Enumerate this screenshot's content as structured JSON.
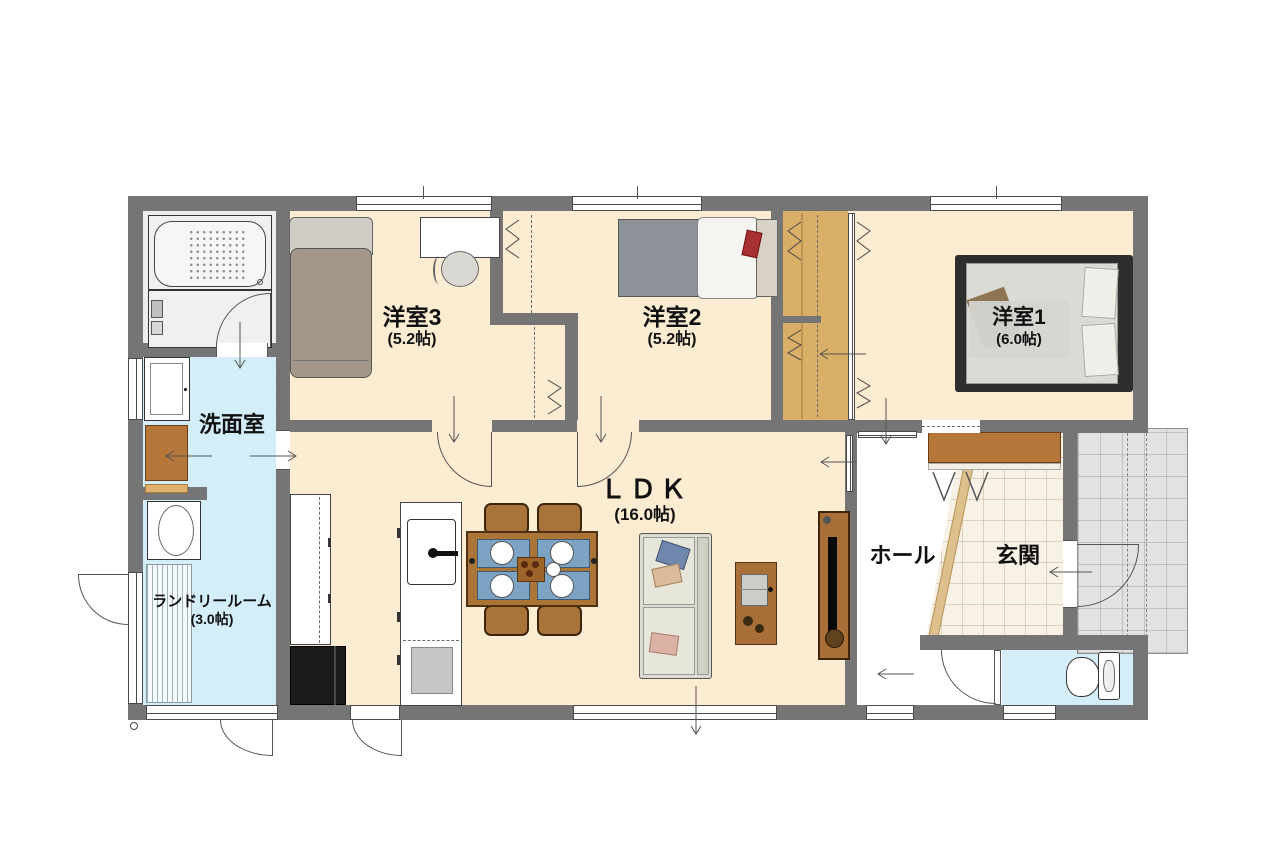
{
  "plan_title": "1LDK house floor plan",
  "rooms": {
    "bedroom3": {
      "name": "洋室3",
      "area": "(5.2帖)"
    },
    "bedroom2": {
      "name": "洋室2",
      "area": "(5.2帖)"
    },
    "bedroom1": {
      "name": "洋室1",
      "area": "(6.0帖)"
    },
    "ldk": {
      "name": "ＬＤＫ",
      "area": "(16.0帖)"
    },
    "washroom": {
      "name": "洗面室"
    },
    "laundry": {
      "name": "ランドリールーム",
      "area": "(3.0帖)"
    },
    "hall": {
      "name": "ホール"
    },
    "entrance": {
      "name": "玄関"
    }
  },
  "colors": {
    "wall": "#757575",
    "room_floor": "#fcecd2",
    "wet_floor": "#d3eef8",
    "wood_closet": "#d9ae67",
    "genkan_tile": "#f8f1e6",
    "porch_tile": "#e2e2e0",
    "bath_floor": "#ededeb"
  }
}
